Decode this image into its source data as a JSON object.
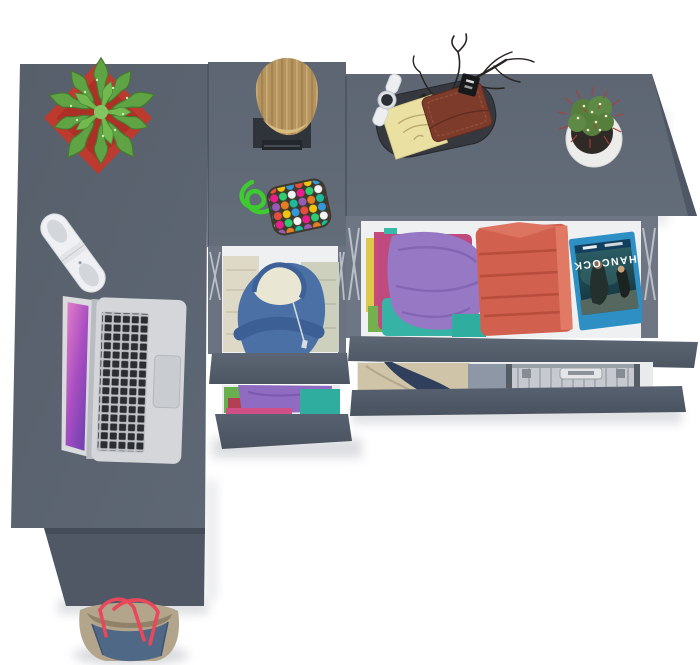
{
  "scene": {
    "type": "3d-render-top-down",
    "description": "Top-down 3D render of an anthracite gray L-shaped desk and two drawer dressers with open drawers of folded clothes, shown on a white studio background",
    "furniture": {
      "desk_top_color": "#59616d",
      "dresser_top_color": "#5e6673",
      "drawer_front_color": "#525c69",
      "drawer_interior_color": "#eef0f2",
      "pieces": [
        "left-desk",
        "middle-narrow-dresser",
        "right-wide-dresser"
      ]
    },
    "bluray": {
      "title": "HANCOCK",
      "case_color": "#2d8fc4",
      "orientation": "upside-down"
    },
    "items": [
      {
        "name": "succulent-plant",
        "detail": "green succulent in red square pot",
        "colors": [
          "#5fa344",
          "#bc3a2e"
        ]
      },
      {
        "name": "portable-speaker",
        "detail": "white pill speaker with oval grills",
        "colors": [
          "#eef0f3"
        ]
      },
      {
        "name": "laptop",
        "detail": "open silver laptop, pink-purple wallpaper, black keys",
        "colors": [
          "#d4d6d9",
          "#c0399b"
        ]
      },
      {
        "name": "log-sculpture",
        "detail": "wood log on dark square base",
        "colors": [
          "#b5945f",
          "#2f343a"
        ]
      },
      {
        "name": "bead-keychain",
        "detail": "green cord keychain with multicolor bead pad",
        "colors": [
          "#3ecb30"
        ]
      },
      {
        "name": "valet-tray",
        "detail": "dark oval tray with notepad, wallet, watch, twig decor and black tag",
        "colors": [
          "#35393f",
          "#eae0a2",
          "#7d3c2b"
        ]
      },
      {
        "name": "cactus",
        "detail": "red-spined cactus in white round pot",
        "colors": [
          "#567f3e",
          "#ececea"
        ]
      },
      {
        "name": "hoodie-drawer",
        "detail": "open narrow drawer with blue hoodie over cream folded clothes",
        "colors": [
          "#4b70a5",
          "#e9e6d4"
        ]
      },
      {
        "name": "clothes-drawer-small",
        "detail": "half-open drawer with purple, teal, red and green folded clothes"
      },
      {
        "name": "clothes-stack-left",
        "detail": "folded purple, teal, magenta, green garments",
        "colors": [
          "#9678c5",
          "#36b3a4",
          "#bf4a7e"
        ]
      },
      {
        "name": "red-towel-stack",
        "detail": "folded coral-red towels",
        "colors": [
          "#d2604e"
        ]
      },
      {
        "name": "bluray-case",
        "detail": "HANCOCK Blu-ray case lying upside down"
      },
      {
        "name": "beige-jacket",
        "detail": "beige and navy garment in lower drawer",
        "colors": [
          "#cfc3a8",
          "#2f3f5c"
        ]
      },
      {
        "name": "aluminum-briefcase",
        "detail": "silver ribbed briefcase in lower drawer",
        "colors": [
          "#c6cad0"
        ]
      },
      {
        "name": "tote-bag",
        "detail": "denim and taupe tote bag with red straps on floor",
        "colors": [
          "#4e6886",
          "#b3a48c",
          "#e8485a"
        ]
      }
    ],
    "palette": {
      "background": "#ffffff",
      "shadow": "#8b919b",
      "metal_slide": "#b9bfc7"
    }
  }
}
